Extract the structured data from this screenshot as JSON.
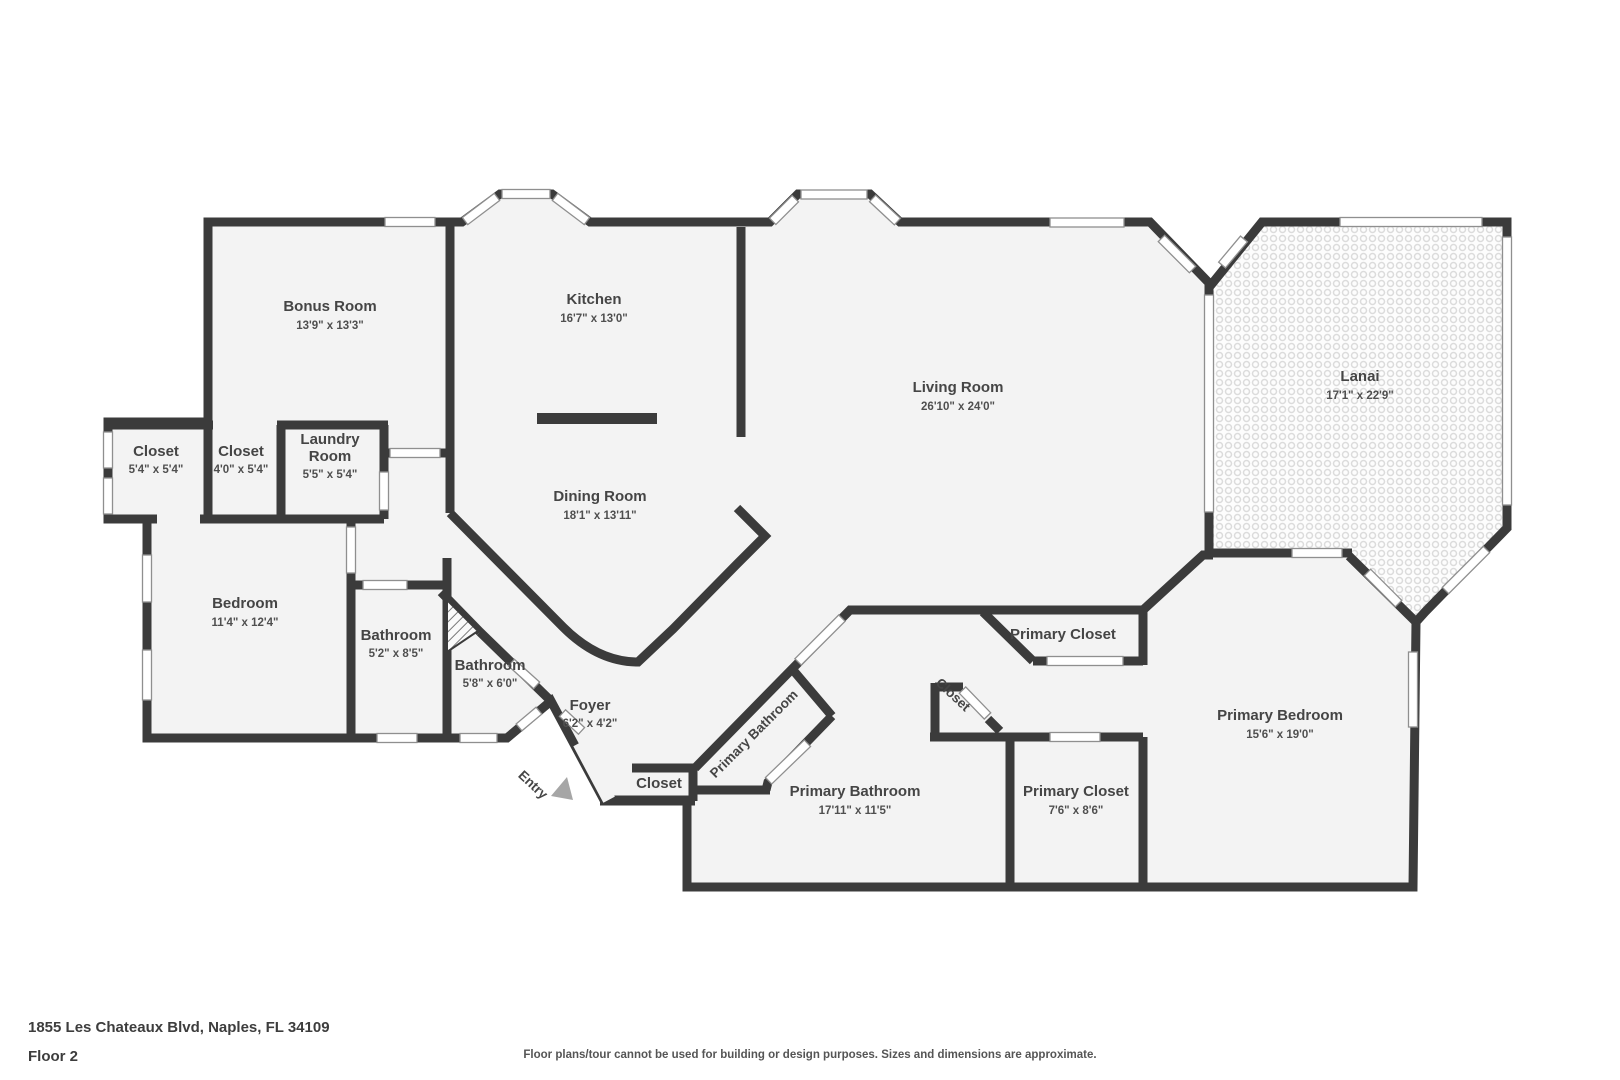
{
  "meta": {
    "address": "1855 Les Chateaux Blvd, Naples, FL 34109",
    "floor": "Floor 2",
    "disclaimer": "Floor plans/tour cannot be used for building or design purposes. Sizes and dimensions are approximate."
  },
  "colors": {
    "wall": "#3b3b3b",
    "floor": "#f3f3f3",
    "lanai_pattern": "#dcdcdc",
    "window_outline": "#8f8f8f",
    "label_text": "#454545",
    "entry_arrow": "#a6a6a6"
  },
  "rooms": [
    {
      "label": "Bonus Room",
      "dims": "13'9\" x 13'3\""
    },
    {
      "label": "Kitchen",
      "dims": "16'7\" x 13'0\""
    },
    {
      "label": "Living Room",
      "dims": "26'10\" x 24'0\""
    },
    {
      "label": "Lanai",
      "dims": "17'1\" x 22'9\""
    },
    {
      "label": "Closet",
      "dims": "5'4\" x 5'4\""
    },
    {
      "label": "Closet",
      "dims": "4'0\" x 5'4\""
    },
    {
      "label_line1": "Laundry",
      "label_line2": "Room",
      "dims": "5'5\" x 5'4\""
    },
    {
      "label": "Dining Room",
      "dims": "18'1\" x 13'11\""
    },
    {
      "label": "Bedroom",
      "dims": "11'4\" x 12'4\""
    },
    {
      "label": "Bathroom",
      "dims": "5'2\" x 8'5\""
    },
    {
      "label": "Bathroom",
      "dims": "5'8\" x 6'0\""
    },
    {
      "label": "Foyer",
      "dims": "6'2\" x 4'2\""
    },
    {
      "label": "Closet"
    },
    {
      "label": "Primary Bathroom"
    },
    {
      "label": "Primary Bathroom",
      "dims": "17'11\" x 11'5\""
    },
    {
      "label": "Closet"
    },
    {
      "label": "Primary Closet"
    },
    {
      "label": "Primary Closet",
      "dims": "7'6\" x 8'6\""
    },
    {
      "label": "Primary Bedroom",
      "dims": "15'6\" x 19'0\""
    },
    {
      "label": "Entry"
    }
  ]
}
